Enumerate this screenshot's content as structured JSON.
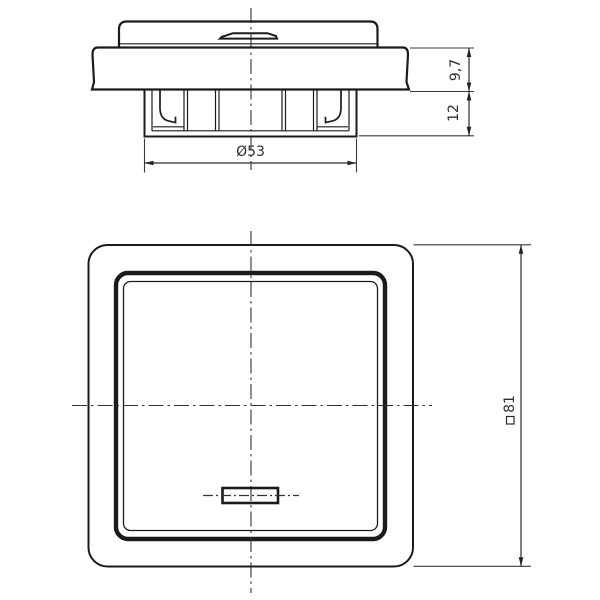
{
  "drawing": {
    "type": "technical-dimension-drawing",
    "subject": "flush-mounted rocker light switch with indicator lens, side view and front view",
    "palette": {
      "line_color": "#1b1b1b",
      "dimension_color": "#3a3a3a",
      "background": "#ffffff"
    },
    "side_view": {
      "dimensions": {
        "frame_depth": "9,7",
        "claw_depth": "12",
        "claw_diameter": "Ø53"
      }
    },
    "front_view": {
      "dimensions": {
        "plate_size": "81",
        "plate_size_symbol": "square"
      }
    }
  }
}
